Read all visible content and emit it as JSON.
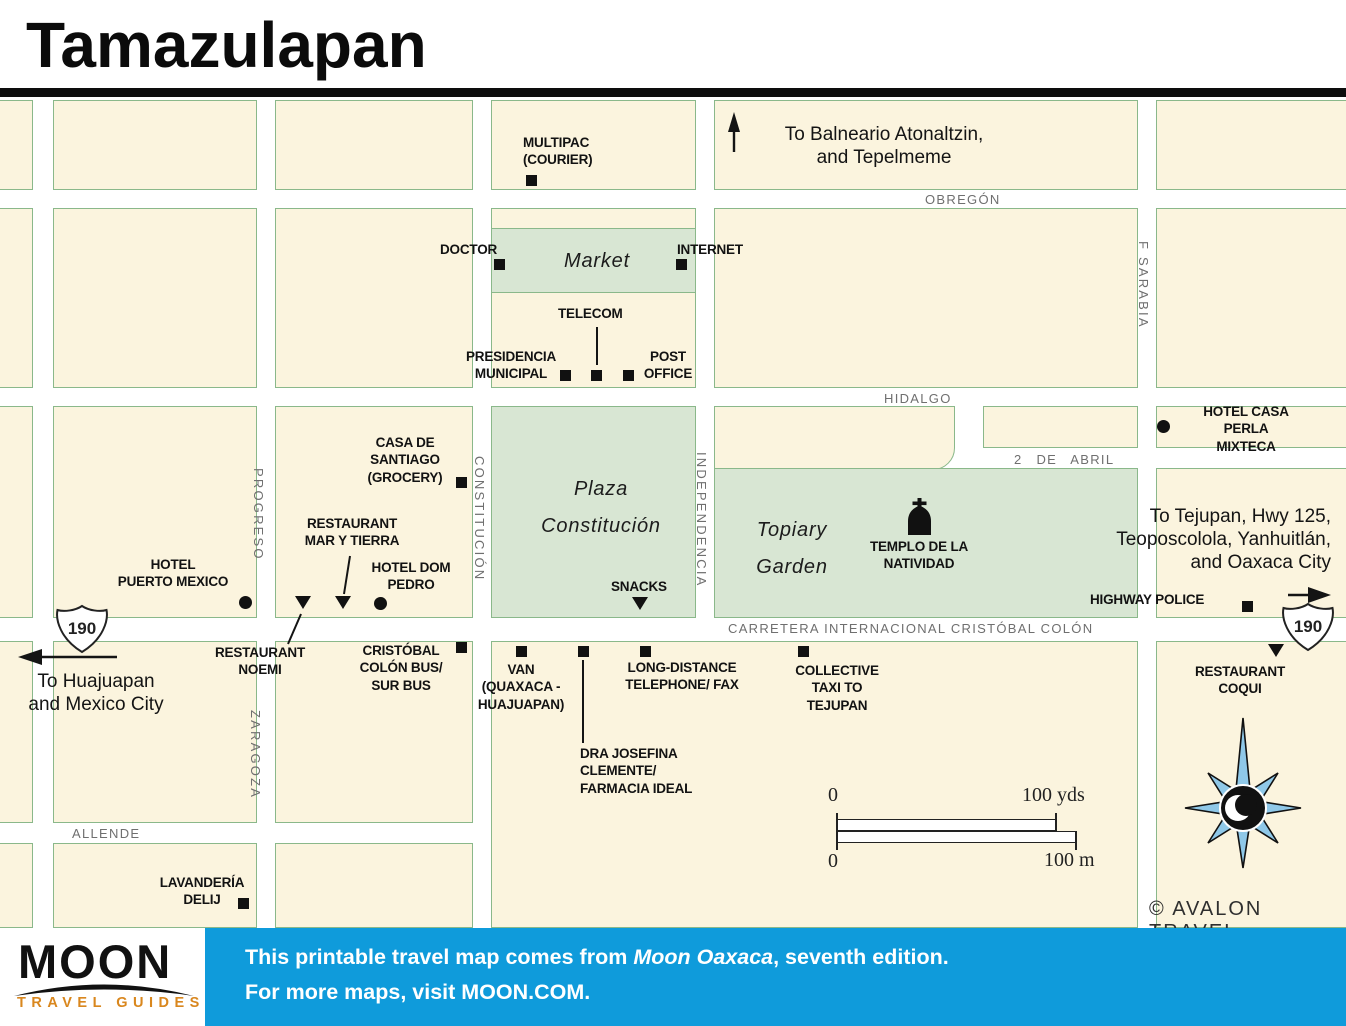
{
  "title": "Tamazulapan",
  "colors": {
    "block_fill": "#fbf4de",
    "block_border": "#8ab88a",
    "garden_fill": "#d8e6d3",
    "footer_blue": "#0f9bdb",
    "brand_orange": "#d9871e",
    "compass_blue": "#8fc8e8"
  },
  "map": {
    "streets": {
      "obregon": "OBREGÓN",
      "hidalgo": "HIDALGO",
      "dos_de_abril": "2 DE ABRIL",
      "carretera": "CARRETERA INTERNACIONAL CRISTÓBAL COLÓN",
      "allende": "ALLENDE",
      "progreso": "PROGRESO",
      "zaragoza": "ZARAGOZA",
      "constitucion": "CONSTITUCIÓN",
      "independencia": "INDEPENDENCIA",
      "f_sarabia": "F SARABIA"
    },
    "areas": {
      "market": "Market",
      "plaza": "Plaza\nConstitución",
      "topiary": "Topiary\nGarden"
    },
    "pois": {
      "multipac": "MULTIPAC\n(COURIER)",
      "doctor": "DOCTOR",
      "internet": "INTERNET",
      "telecom": "TELECOM",
      "presidencia": "PRESIDENCIA\nMUNICIPAL",
      "post_office": "POST\nOFFICE",
      "casa_santiago": "CASA DE\nSANTIAGO\n(GROCERY)",
      "restaurant_mar_y_tierra": "RESTAURANT\nMAR Y TIERRA",
      "hotel_dom_pedro": "HOTEL DOM\nPEDRO",
      "hotel_puerto_mexico": "HOTEL\nPUERTO MEXICO",
      "snacks": "SNACKS",
      "templo": "TEMPLO DE LA\nNATIVIDAD",
      "hotel_casa_perla": "HOTEL CASA\nPERLA MIXTECA",
      "highway_police": "HIGHWAY POLICE",
      "restaurant_noemi": "RESTAURANT\nNOEMI",
      "cristobal_colon_bus": "CRISTÓBAL\nCOLÓN BUS/\nSUR BUS",
      "van": "VAN\n(QUAXACA -\nHUAJUAPAN)",
      "long_distance": "LONG-DISTANCE\nTELEPHONE/ FAX",
      "collective_taxi": "COLLECTIVE\nTAXI TO\nTEJUPAN",
      "dra_josefina": "DRA JOSEFINA\nCLEMENTE/\nFARMACIA IDEAL",
      "restaurant_coqui": "RESTAURANT\nCOQUI",
      "lavanderia": "LAVANDERÍA\nDELIJ"
    },
    "destinations": {
      "north": "To Balneario Atonaltzin,\nand Tepelmeme",
      "west": "To Huajuapan\nand Mexico City",
      "east": "To Tejupan, Hwy 125,\nTeoposcolola, Yanhuitlán,\nand Oaxaca City"
    },
    "highway_route": "190",
    "scale": {
      "zero_top": "0",
      "yds": "100 yds",
      "zero_bottom": "0",
      "m": "100 m"
    },
    "credit": "© AVALON TRAVEL"
  },
  "footer": {
    "brand": "MOON",
    "tagline": "TRAVEL GUIDES",
    "line1_prefix": "This printable travel map comes from ",
    "line1_italic": "Moon Oaxaca",
    "line1_suffix": ", seventh edition.",
    "line2": "For more maps, visit MOON.COM."
  }
}
